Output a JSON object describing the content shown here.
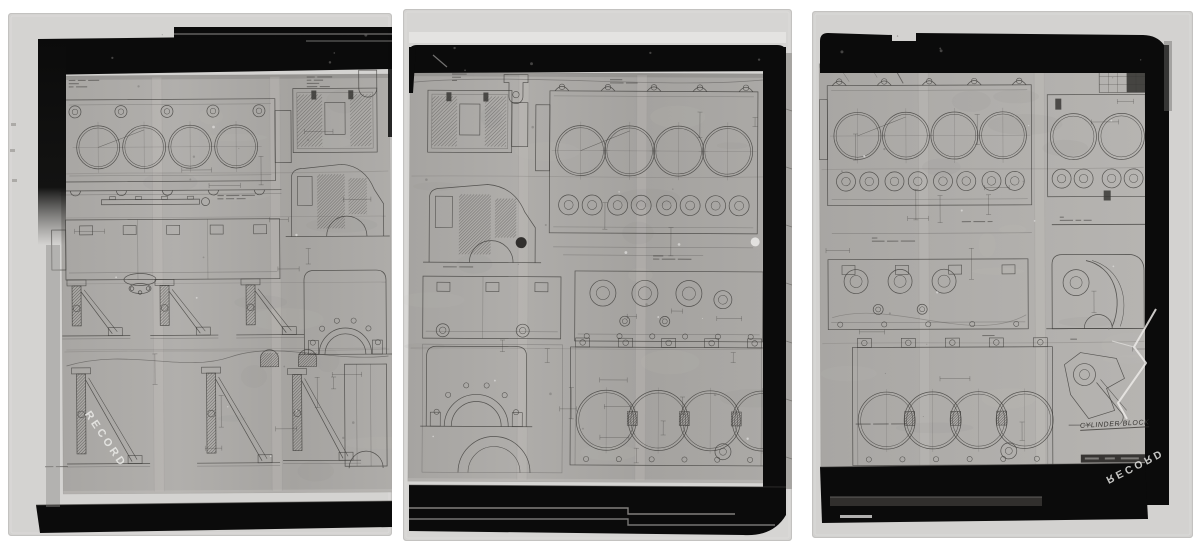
{
  "document": {
    "kind": "Photographic record strip of engineering drawings",
    "subject": "Engine cylinder block drawing sheets",
    "frame_count": 3
  },
  "frames": [
    {
      "id": "frame-1",
      "stamp": "RECORD",
      "annotation": ""
    },
    {
      "id": "frame-2",
      "stamp": "",
      "annotation": ""
    },
    {
      "id": "frame-3",
      "stamp": "RECORD",
      "annotation": "CYLINDER BLOCK"
    }
  ],
  "palette": {
    "page_bg": "#ffffff",
    "mat": "#d5d4d2",
    "film": "#0b0b0b",
    "sheet": "#a9a7a4",
    "ink": "#3a3836",
    "stamp": "#eeeeea"
  }
}
